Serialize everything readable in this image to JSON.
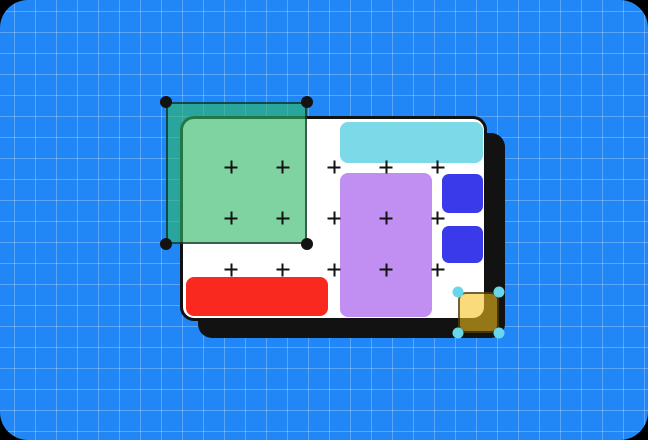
{
  "meta": {
    "description": "Design-tool canvas illustration: blue grid background, white artboard with hard black shadow, colored shapes, plus-markers, and two selected translucent shapes with corner handles",
    "text_content": "none — illustration contains no text"
  },
  "colors": {
    "page_bg": "#000000",
    "bg": "#2187F7",
    "grid": "rgba(255,255,255,0.26)",
    "ink": "#121212",
    "card": "#FFFFFF",
    "cyan": "#7BD9E8",
    "purple": "#C18FF2",
    "blue": "#3B3AEA",
    "red": "#F9291F",
    "green_fill": "rgba(47,184,103,0.62)",
    "green_handle": "#121212",
    "orange_fill": "rgba(244,193,28,0.58)",
    "orange_handle": "#69D6E9",
    "sel_border": "rgba(0,0,0,0.55)"
  },
  "scene": {
    "background": "blue engineering grid, 21px pitch, rounded 28px corners over black",
    "artboard": "white rounded card with 3px black outline and 18px hard offset black shadow"
  },
  "shapes": [
    {
      "name": "cyan-bar",
      "kind": "rounded-rect",
      "fill_key": "cyan"
    },
    {
      "name": "purple-rect",
      "kind": "rounded-rect",
      "fill_key": "purple"
    },
    {
      "name": "blue-square-1",
      "kind": "rounded-square",
      "fill_key": "blue"
    },
    {
      "name": "blue-square-2",
      "kind": "rounded-square",
      "fill_key": "blue"
    },
    {
      "name": "red-bar",
      "kind": "rounded-rect",
      "fill_key": "red"
    }
  ],
  "selections": [
    {
      "name": "green-rect",
      "state": "selected",
      "handle_style": "black circles, 4 corners"
    },
    {
      "name": "orange-square",
      "state": "selected",
      "handle_style": "cyan circles, 4 corners"
    }
  ],
  "plus_markers": {
    "rows": 3,
    "cols": 5,
    "origin_x": 231,
    "origin_y": 167,
    "dx": 51.7,
    "dy": 51.3
  }
}
